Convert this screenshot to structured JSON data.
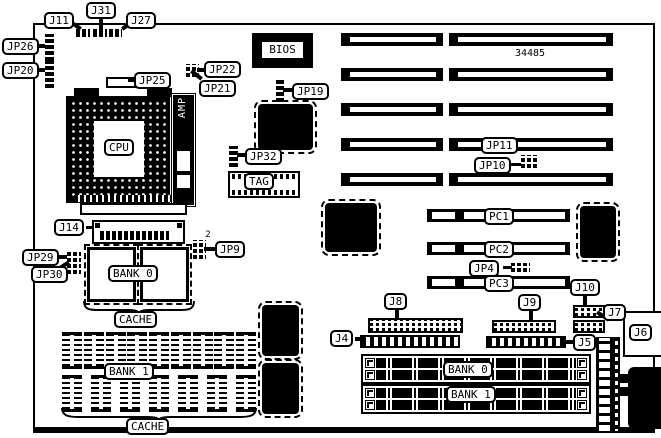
{
  "figure": {
    "board_number": "34485",
    "labels": {
      "j11": "J11",
      "j31": "J31",
      "j27": "J27",
      "jp26": "JP26",
      "jp20": "JP20",
      "jp25": "JP25",
      "jp22": "JP22",
      "jp21": "JP21",
      "jp19": "JP19",
      "bios": "BIOS",
      "cpu": "CPU",
      "amp": "AMP",
      "jp32": "JP32",
      "tag": "TAG",
      "jp11": "JP11",
      "jp10": "JP10",
      "j14": "J14",
      "jp29": "JP29",
      "jp30": "JP30",
      "jp9": "JP9",
      "jp9_pin": "2",
      "bank0_cache": "BANK 0",
      "cache_upper": "CACHE",
      "bank1_cache": "BANK 1",
      "cache_lower": "CACHE",
      "pc1": "PC1",
      "pc2": "PC2",
      "pc3": "PC3",
      "jp4": "JP4",
      "j8": "J8",
      "j4": "J4",
      "j9": "J9",
      "j10": "J10",
      "j7": "J7",
      "j5": "J5",
      "j6": "J6",
      "bank0_simm": "BANK 0",
      "bank1_simm": "BANK 1"
    },
    "colors": {
      "ink": "#000000",
      "paper": "#ffffff"
    }
  }
}
